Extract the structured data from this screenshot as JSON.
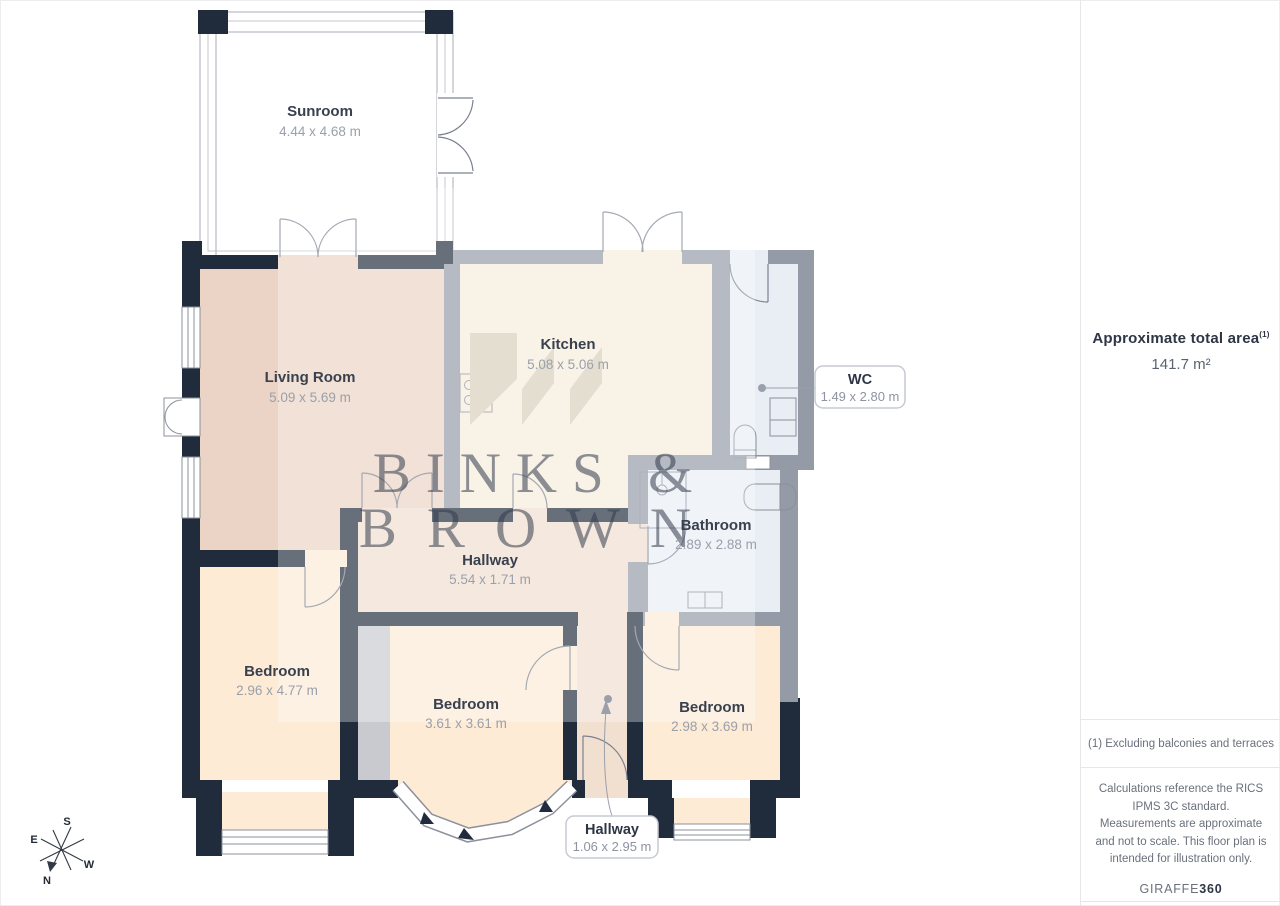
{
  "plan": {
    "rooms": [
      {
        "id": "sunroom",
        "name": "Sunroom",
        "dims": "4.44 x 4.68 m"
      },
      {
        "id": "living-room",
        "name": "Living Room",
        "dims": "5.09 x 5.69 m"
      },
      {
        "id": "kitchen",
        "name": "Kitchen",
        "dims": "5.08 x 5.06 m"
      },
      {
        "id": "hallway",
        "name": "Hallway",
        "dims": "5.54 x 1.71 m"
      },
      {
        "id": "bathroom",
        "name": "Bathroom",
        "dims": "2.89 x 2.88 m"
      },
      {
        "id": "bedroom-left",
        "name": "Bedroom",
        "dims": "2.96 x 4.77 m"
      },
      {
        "id": "bedroom-middle",
        "name": "Bedroom",
        "dims": "3.61 x 3.61 m"
      },
      {
        "id": "bedroom-right",
        "name": "Bedroom",
        "dims": "2.98 x 3.69 m"
      }
    ],
    "callouts": [
      {
        "id": "wc",
        "name": "WC",
        "dims": "1.49 x 2.80 m"
      },
      {
        "id": "hallway-small",
        "name": "Hallway",
        "dims": "1.06 x 2.95 m"
      }
    ],
    "compass": {
      "n": "N",
      "s": "S",
      "e": "E",
      "w": "W"
    },
    "colors": {
      "wall_dark": "#202b3c",
      "wall_gray": "#949aa6",
      "floor_salmon": "#ebd3c5",
      "floor_cream": "#f6ecdc",
      "floor_peach": "#fdebd6",
      "floor_hall": "#f1dfd0",
      "floor_blue": "#e9edf4",
      "logo_tan": "#d7cebb"
    }
  },
  "watermark": {
    "line1": "BINKS &",
    "line2": "BROWN"
  },
  "sidebar": {
    "area_title": "Approximate total area",
    "area_superscript": "(1)",
    "area_value": "141.7 m²",
    "footnote": "(1) Excluding balconies and terraces",
    "disclaimer": "Calculations reference the RICS IPMS 3C standard. Measurements are approximate and not to scale. This floor plan is intended for illustration only.",
    "brand": "GIRAFFE",
    "brand_suffix": "360"
  }
}
